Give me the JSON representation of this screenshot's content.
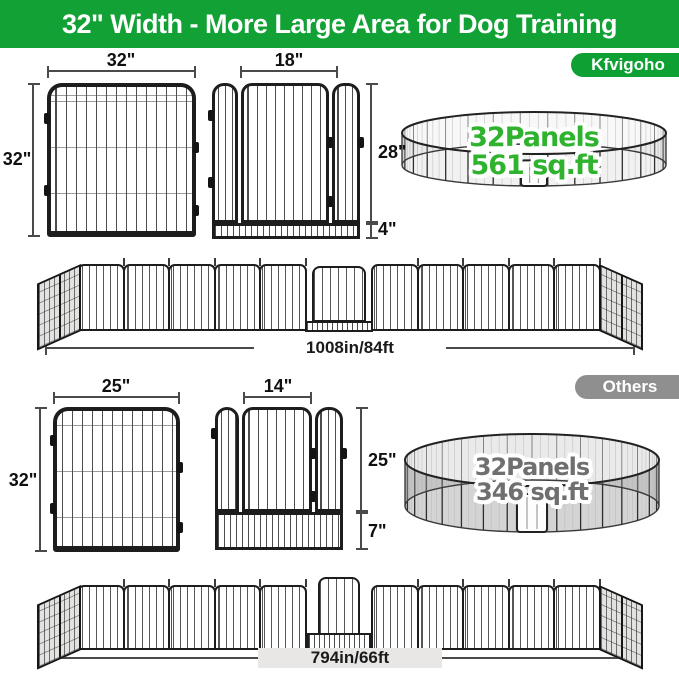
{
  "header": {
    "title": "32\" Width - More Large Area for Dog Training"
  },
  "kfvigoho": {
    "badge": "Kfvigoho",
    "panel": {
      "width": "32\"",
      "height": "32\""
    },
    "door_panel": {
      "door_width": "18\"",
      "height": "28\"",
      "bottom_bar": "4\""
    },
    "pen": {
      "panels": "32Panels",
      "area": "561 sq.ft"
    },
    "row_length": "1008in/84ft"
  },
  "others": {
    "badge": "Others",
    "panel": {
      "width": "25\"",
      "height": "32\""
    },
    "door_panel": {
      "door_width": "14\"",
      "height": "25\"",
      "bottom_bar": "7\""
    },
    "pen": {
      "panels": "32Panels",
      "area": "346 sq.ft"
    },
    "row_length": "794in/66ft"
  },
  "colors": {
    "header_green": "#11a135",
    "badge_green": "#0fa034",
    "badge_gray": "#8f8f8f",
    "section_gray": "#e8e7e5",
    "pen_text_green": "#2fb32f",
    "pen_text_gray": "#6f6f6f",
    "frame_dark": "#1d1d1d"
  }
}
